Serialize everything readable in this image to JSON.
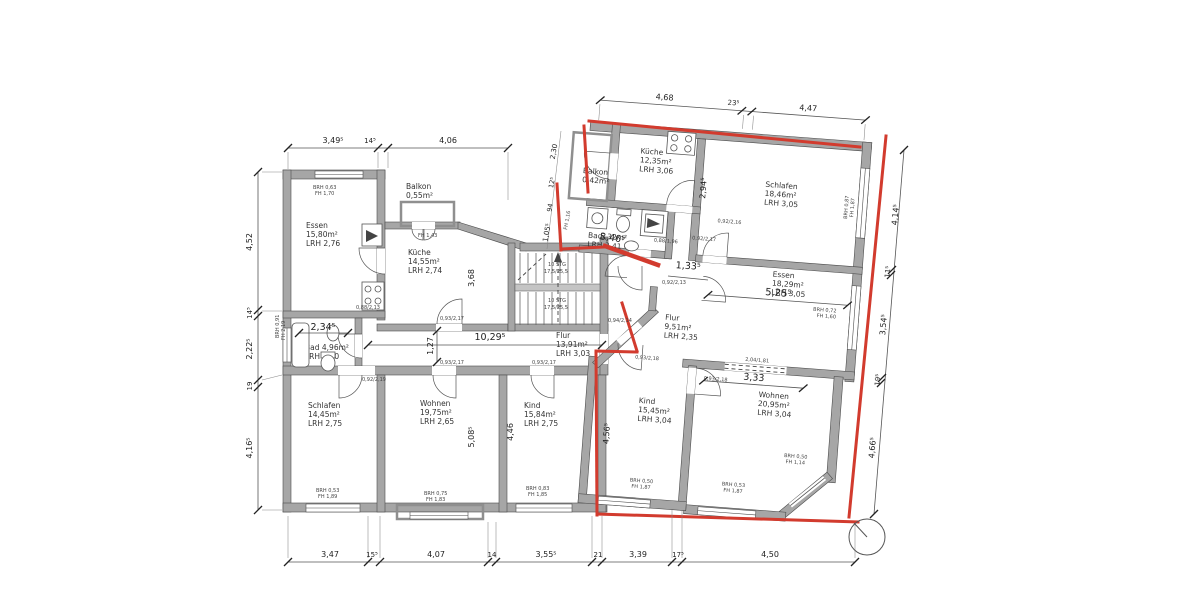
{
  "rooms": {
    "essen_l": {
      "l1": "Essen",
      "l2": "15,80m²",
      "l3": "LRH 2,76"
    },
    "balkon_l": {
      "l1": "Balkon",
      "l2": "0,55m²",
      "l3": ""
    },
    "kueche_l": {
      "l1": "Küche",
      "l2": "14,55m²",
      "l3": "LRH 2,74"
    },
    "bad_l": {
      "l1": "Bad 4,96m²",
      "l2": "LRH 3,00",
      "l3": ""
    },
    "flur_l": {
      "l1": "Flur",
      "l2": "13,91m²",
      "l3": "LRH 3,03"
    },
    "schlafen_l": {
      "l1": "Schlafen",
      "l2": "14,45m²",
      "l3": "LRH 2,75"
    },
    "wohnen_l": {
      "l1": "Wohnen",
      "l2": "19,75m²",
      "l3": "LRH 2,65"
    },
    "kind_l": {
      "l1": "Kind",
      "l2": "15,84m²",
      "l3": "LRH 2,75"
    },
    "balkon_r": {
      "l1": "Balkon",
      "l2": "0,42m²",
      "l3": ""
    },
    "kueche_r": {
      "l1": "Küche",
      "l2": "12,35m²",
      "l3": "LRH 3,06"
    },
    "bad_r": {
      "l1": "Bad",
      "l2": "5,32m²",
      "l3": "LRH 2,41"
    },
    "schlafen_r": {
      "l1": "Schlafen",
      "l2": "18,46m²",
      "l3": "LRH 3,05"
    },
    "essen_r": {
      "l1": "Essen",
      "l2": "18,29m²",
      "l3": "LRH 3,05"
    },
    "flur_r": {
      "l1": "Flur",
      "l2": "9,51m²",
      "l3": "LRH 2,35"
    },
    "kind_r": {
      "l1": "Kind",
      "l2": "15,45m²",
      "l3": "LRH 3,04"
    },
    "wohnen_r": {
      "l1": "Wohnen",
      "l2": "20,95m²",
      "l3": "LRH 3,04"
    }
  },
  "stairs": {
    "l1": "10 STG",
    "l2": "17,5/25,5",
    "l3": "10 STG",
    "l4": "17,5/25,5"
  },
  "dims": {
    "top_left": [
      "3,49⁵",
      "14⁵",
      "4,06"
    ],
    "top_right": [
      "4,68",
      "23⁵",
      "4,47"
    ],
    "left": [
      "4,52",
      "14⁵",
      "2,22⁵",
      "19",
      "4,16⁵"
    ],
    "right": [
      "4,14⁵",
      "11⁵",
      "3,54⁵",
      "19⁵",
      "4,66⁵"
    ],
    "bottom": [
      "3,47",
      "15⁵",
      "4,07",
      "14",
      "3,55⁵",
      "21",
      "3,39",
      "17⁵",
      "4,50"
    ],
    "inner": {
      "corridor": "10,29⁵",
      "kitchen_h": "3,68",
      "entry": "3,46⁵",
      "entry2": "1,33⁵",
      "bad_w": "2,34⁵",
      "bad_h": "1,27",
      "wohnen_h": "5,08⁵",
      "kind_h": "4,46",
      "kind_r_h": "4,56⁵",
      "essen_r_w": "5,25⁵",
      "wohnen_r_w": "3,33",
      "kueche_r_h": "2,94⁵",
      "e1": "2,30",
      "e2": "12⁵",
      "e3": "94",
      "e4": "1,05⁵",
      "opening": "2,04/1,81"
    }
  },
  "windows": {
    "essen_l": {
      "l1": "BRH 0,63",
      "l2": "FH 1,70"
    },
    "bad_l": {
      "l1": "BRH 0,91",
      "l2": "FH 2,19"
    },
    "schlafen_l": {
      "l1": "BRH 0,53",
      "l2": "FH 1,89"
    },
    "wohnen_l": {
      "l1": "BRH 0,75",
      "l2": "FH 1,83"
    },
    "kind_l": {
      "l1": "BRH 0,83",
      "l2": "FH 1,85"
    },
    "kind_r": {
      "l1": "BRH 0,50",
      "l2": "FH 1,87"
    },
    "wohnen_r": {
      "l1": "BRH 0,53",
      "l2": "FH 1,87"
    },
    "bay": {
      "l1": "BRH 0,50",
      "l2": "FH 1,14"
    },
    "essen_r": {
      "l1": "BRH 0,72",
      "l2": "FH 1,60"
    },
    "schlafen_r": {
      "l1": "BRH 0,87",
      "l2": "FH 1,87"
    },
    "balkon_r": "FH 1,16",
    "balkon_l": "FH 1,43"
  },
  "doors": {
    "d1": "0,92/2,19",
    "d2": "0,93/2,17",
    "d3": "0,93/2,17",
    "d4": "0,93/2,17",
    "d5": "0,88/2,13",
    "d6": "0,94/2,14",
    "d7": "0,92/2,13",
    "d8": "0,92/2,16",
    "d9": "0,92/2,17",
    "d10": "0,93/2,18",
    "d11": "0,93/2,18",
    "d12": "0,88/1,96"
  },
  "colors": {
    "wall": "#a6a6a6",
    "outline": "#4d4d4d",
    "marking_red": "#d23b2e"
  }
}
